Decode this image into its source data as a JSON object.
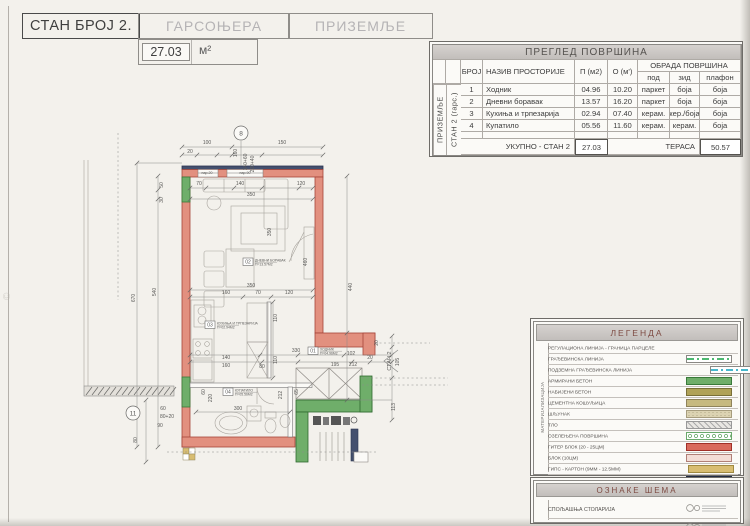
{
  "header": {
    "apartment": "СТАН БРОЈ 2.",
    "type": "ГАРСОЊЕРА",
    "floor": "ПРИЗЕМЉЕ",
    "area_value": "27.03",
    "area_unit": "м²"
  },
  "watermark": "©",
  "area_table": {
    "title": "ПРЕГЛЕД ПОВРШИНА",
    "col_broj": "БРОЈ",
    "col_name": "НАЗИВ ПРОСТОРИЈЕ",
    "col_p": "П (м2)",
    "col_o": "О (м')",
    "obrada": "ОБРАДА ПОВРШИНА",
    "col_pod": "под",
    "col_zid": "зид",
    "col_plafon": "плафон",
    "side_outer": "ПРИЗЕМЉЕ",
    "side_inner": "СТАН 2 (гарс.)",
    "rows": [
      {
        "n": "1",
        "name": "Ходник",
        "p": "04.96",
        "o": "10.20",
        "pod": "паркет",
        "zid": "боја",
        "plafon": "боја"
      },
      {
        "n": "2",
        "name": "Дневни боравак",
        "p": "13.57",
        "o": "16.20",
        "pod": "паркет",
        "zid": "боја",
        "plafon": "боја"
      },
      {
        "n": "3",
        "name": "Кухиња и трпезарија",
        "p": "02.94",
        "o": "07.40",
        "pod": "керам.",
        "zid": "кер./боја",
        "plafon": "боја"
      },
      {
        "n": "4",
        "name": "Купатило",
        "p": "05.56",
        "o": "11.60",
        "pod": "керам.",
        "zid": "керам.",
        "plafon": "боја"
      }
    ],
    "total_label": "УКУПНО - СТАН 2",
    "total_value": "27.03",
    "terrace_label": "ТЕРАСА",
    "terrace_value": "50.57"
  },
  "legend": {
    "title": "ЛЕГЕНДА",
    "side": "МАТЕРИЈАЛИЗАЦИЈА",
    "items": [
      {
        "label": "РЕГУЛАЦИОНА ЛИНИЈА - ГРАНИЦА ПАРЦЕЛЕ",
        "swatch": "line-magenta"
      },
      {
        "label": "ГРАЂЕВИНСКА ЛИНИЈА",
        "swatch": "line-green"
      },
      {
        "label": "ПОДЗЕМНА ГРАЂЕВИНСКА ЛИНИЈА",
        "swatch": "line-cyan"
      },
      {
        "label": "АРМИРАНИ БЕТОН",
        "swatch": "fill-green"
      },
      {
        "label": "НАБИЈЕНИ БЕТОН",
        "swatch": "fill-olive"
      },
      {
        "label": "ЦЕМЕНТНА КОШУЉИЦА",
        "swatch": "fill-cement"
      },
      {
        "label": "ШЉУНАК",
        "swatch": "fill-gravel"
      },
      {
        "label": "ТЛО",
        "swatch": "hatch-gray"
      },
      {
        "label": "ОЗЕЛЕЊЕНА ПОВРШИНА",
        "swatch": "dots-green"
      },
      {
        "label": "ГИТЕР БЛОК (20 - 25ЦМ)",
        "swatch": "fill-red"
      },
      {
        "label": "БЛОК (10ЦМ)",
        "swatch": "fill-pink"
      },
      {
        "label": "ГИПС - КАРТОН (9ММ - 12.5ММ)",
        "swatch": "fill-gold"
      },
      {
        "label": "ТЕРМОИЗОЛАЦИЈА",
        "swatch": "fill-navy"
      },
      {
        "label": "ХИДРОИЗОЛАЦИЈА - ЗАПТИВКЕ",
        "swatch": "dash-cyan"
      }
    ]
  },
  "oznake": {
    "title": "ОЗНАКЕ ШЕМА",
    "rows": [
      "СПОЉАШЊА СТОЛАРИЈА",
      "УНУТРАШЊА СТОЛАРИЈА"
    ]
  },
  "plan": {
    "entry_label": "СТАН 2",
    "markers": [
      {
        "t": "8",
        "x": 241,
        "y": 133
      },
      {
        "t": "11",
        "x": 133,
        "y": 413
      }
    ],
    "rooms": [
      {
        "tag": "01",
        "name": "ХОДНИК",
        "area": "П=04.96М2",
        "x": 308,
        "y": 347
      },
      {
        "tag": "02",
        "name": "ДНЕВНИ БОРАВАК",
        "area": "П=13.57М2",
        "x": 243,
        "y": 258
      },
      {
        "tag": "03",
        "name": "КУХИЊА И ТРПЕЗАРИЈА",
        "area": "П=02.94М2",
        "x": 205,
        "y": 321
      },
      {
        "tag": "04",
        "name": "КУПАТИЛО",
        "area": "П=05.56М2",
        "x": 223,
        "y": 388
      }
    ],
    "par_labels": [
      {
        "x": 207,
        "y": 174,
        "t": "пар.20"
      },
      {
        "x": 245,
        "y": 174,
        "t": "пар.90"
      }
    ],
    "dims": [
      {
        "x": 207,
        "y": 144,
        "r": 0,
        "t": "100"
      },
      {
        "x": 282,
        "y": 144,
        "r": 0,
        "t": "150"
      },
      {
        "x": 190,
        "y": 153,
        "r": 0,
        "t": "20"
      },
      {
        "x": 237,
        "y": 153,
        "r": -90,
        "t": "160"
      },
      {
        "x": 247,
        "y": 162,
        "r": -90,
        "t": "140+60"
      },
      {
        "x": 254,
        "y": 164,
        "r": -90,
        "t": "220+40"
      },
      {
        "x": 135,
        "y": 298,
        "r": -90,
        "t": "670"
      },
      {
        "x": 156,
        "y": 292,
        "r": -90,
        "t": "540"
      },
      {
        "x": 163,
        "y": 185,
        "r": -90,
        "t": "50"
      },
      {
        "x": 163,
        "y": 200,
        "r": -90,
        "t": "30"
      },
      {
        "x": 352,
        "y": 287,
        "r": -90,
        "t": "440"
      },
      {
        "x": 307,
        "y": 262,
        "r": -90,
        "t": "460"
      },
      {
        "x": 271,
        "y": 232,
        "r": -90,
        "t": "350"
      },
      {
        "x": 199,
        "y": 185,
        "r": 0,
        "t": "70"
      },
      {
        "x": 240,
        "y": 185,
        "r": 0,
        "t": "140"
      },
      {
        "x": 301,
        "y": 185,
        "r": 0,
        "t": "120"
      },
      {
        "x": 251,
        "y": 196,
        "r": 0,
        "t": "350"
      },
      {
        "x": 251,
        "y": 287,
        "r": 0,
        "t": "350"
      },
      {
        "x": 226,
        "y": 294,
        "r": 0,
        "t": "160"
      },
      {
        "x": 258,
        "y": 294,
        "r": 0,
        "t": "70"
      },
      {
        "x": 289,
        "y": 294,
        "r": 0,
        "t": "120"
      },
      {
        "x": 277,
        "y": 318,
        "r": -90,
        "t": "110"
      },
      {
        "x": 277,
        "y": 360,
        "r": -90,
        "t": "110"
      },
      {
        "x": 296,
        "y": 352,
        "r": 0,
        "t": "330"
      },
      {
        "x": 351,
        "y": 355,
        "r": 0,
        "t": "102"
      },
      {
        "x": 353,
        "y": 366,
        "r": 0,
        "t": "212"
      },
      {
        "x": 335,
        "y": 366,
        "r": 0,
        "t": "195"
      },
      {
        "x": 370,
        "y": 359,
        "r": 0,
        "t": "20"
      },
      {
        "x": 226,
        "y": 359,
        "r": 0,
        "t": "140"
      },
      {
        "x": 226,
        "y": 367,
        "r": 0,
        "t": "160"
      },
      {
        "x": 262,
        "y": 368,
        "r": 0,
        "t": "80"
      },
      {
        "x": 205,
        "y": 392,
        "r": -90,
        "t": "60"
      },
      {
        "x": 212,
        "y": 398,
        "r": -90,
        "t": "220"
      },
      {
        "x": 238,
        "y": 410,
        "r": 0,
        "t": "300"
      },
      {
        "x": 282,
        "y": 395,
        "r": -90,
        "t": "212"
      },
      {
        "x": 298,
        "y": 392,
        "r": -90,
        "t": "65"
      },
      {
        "x": 399,
        "y": 362,
        "r": -90,
        "t": "105"
      },
      {
        "x": 395,
        "y": 407,
        "r": -90,
        "t": "113"
      },
      {
        "x": 378,
        "y": 343,
        "r": -90,
        "t": "20"
      },
      {
        "x": 163,
        "y": 410,
        "r": 0,
        "t": "60"
      },
      {
        "x": 167,
        "y": 418,
        "r": 0,
        "t": "80+20"
      },
      {
        "x": 160,
        "y": 427,
        "r": 0,
        "t": "90"
      },
      {
        "x": 137,
        "y": 440,
        "r": -90,
        "t": "80"
      }
    ]
  },
  "colors": {
    "wall_block": "#e2907f",
    "wall_outline": "#a6453a",
    "concrete_green": "#6fae6a",
    "insulation_navy": "#44506e",
    "gips_gold": "#d8bd72",
    "paper": "#f3f1ec",
    "legend_magenta": "#d4509c",
    "legend_green": "#4db870",
    "legend_cyan": "#46b8cc"
  }
}
